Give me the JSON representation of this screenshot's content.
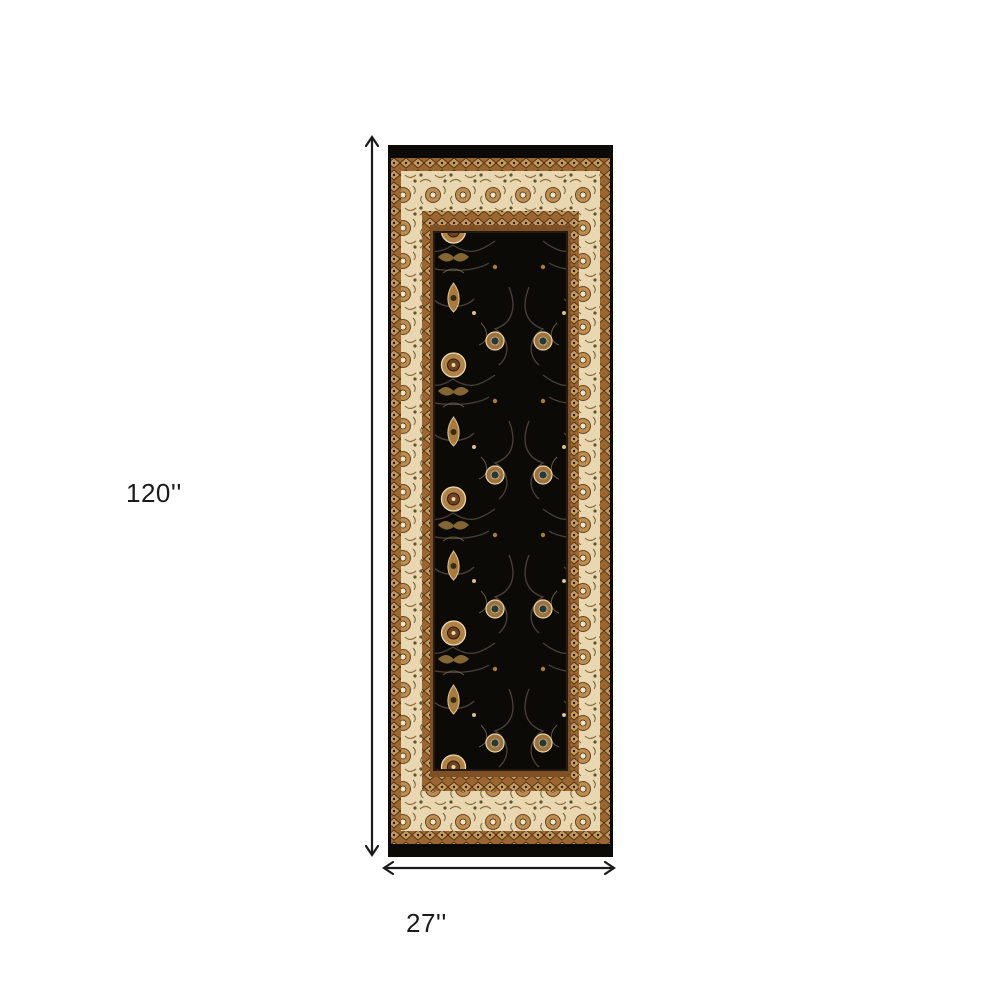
{
  "product": {
    "kind": "oriental-runner-rug",
    "description": "Black and ivory traditional oriental runner rug shown flat with dimension arrows"
  },
  "dimensions": {
    "height_label": "120''",
    "width_label": "27''"
  },
  "colors": {
    "background": "#ffffff",
    "dimension_line": "#1b1b1b",
    "rug_field_black": "#0c0a07",
    "rug_border_ivory": "#e9d7b2",
    "rug_guard_tan": "#9a6631",
    "rug_frame_brown": "#7d5026",
    "rug_accent_gold": "#b08245",
    "rug_accent_cream": "#e8d4a4",
    "rug_accent_teal": "#233a3d"
  },
  "icons": {
    "height_arrow": "vertical-double-arrow",
    "width_arrow": "horizontal-double-arrow"
  }
}
